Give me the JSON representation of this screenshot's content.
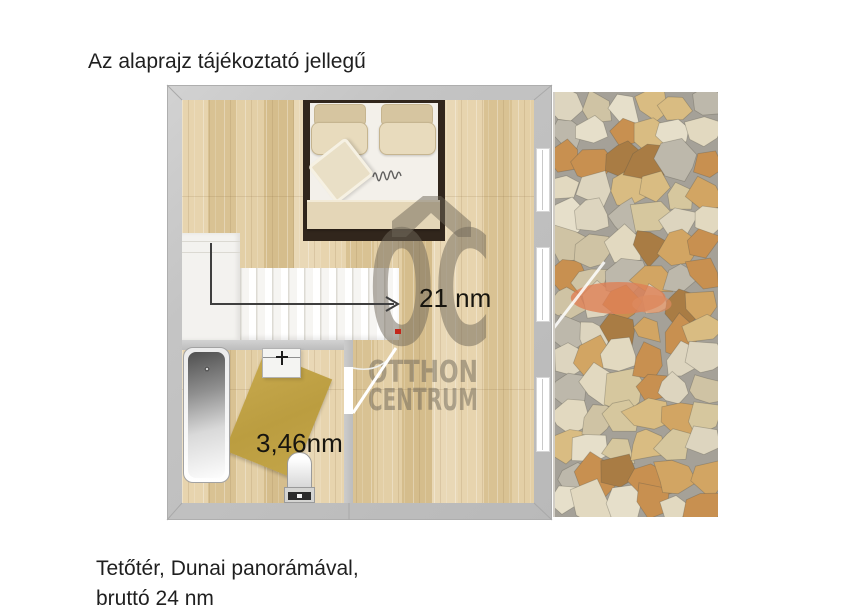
{
  "title": "Az alaprajz tájékoztató jellegű",
  "plan": {
    "main_room_area": "21 nm",
    "bathroom_area": "3,46nm"
  },
  "watermark": {
    "logo": "OC",
    "name_line1": "OTTHON",
    "name_line2": "CENTRUM"
  },
  "footer": {
    "line1": "Tetőtér, Dunai panorámával,",
    "line2": "bruttó 24 nm"
  },
  "colors": {
    "wall_gray": "#c4c4c4",
    "wood_floor": "#ddc79e",
    "rug_mustard": "#c0a246",
    "watermark_gray_brown": "#6e6557",
    "marker_red": "#c3261b",
    "stone_grout": "#a5a198"
  }
}
